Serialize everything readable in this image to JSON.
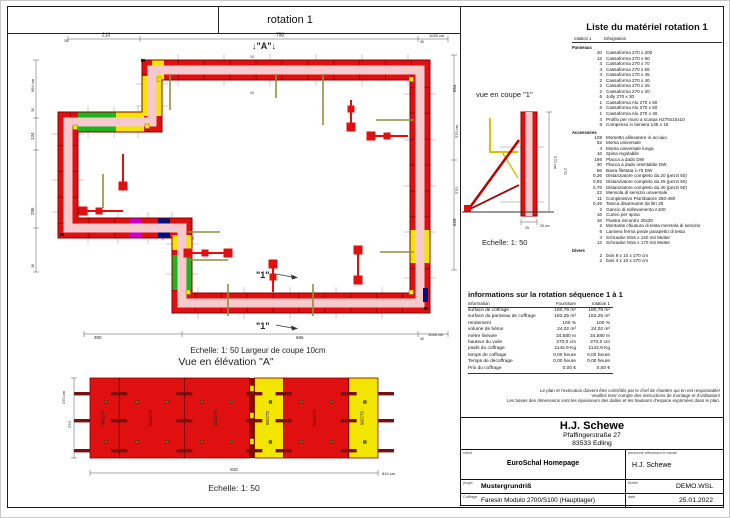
{
  "sheet": {
    "tab_label": "rotation 1"
  },
  "plan": {
    "marker_a": "↓\"A\"↓",
    "marker_1": "\"1\"",
    "dims": {
      "top_25": "25",
      "top_210": "210",
      "top_750": "750",
      "top_30": "30",
      "top_total": "1045 cm",
      "left_total": "694 cm",
      "left_30": "30",
      "left_134": "134",
      "left_295": "295",
      "left_36": "36",
      "right_654": "654",
      "right_628": "628",
      "bottom_300": "300",
      "bottom_665": "665",
      "bottom_30": "30",
      "bottom_total": "1045 cm",
      "tie_10a": "10",
      "tie_10b": "10",
      "wall_15a": "15",
      "wall_15b": "15"
    }
  },
  "coupe": {
    "title": "vue en coupe \"1\"",
    "scale": "Echelle: 1: 50",
    "dim_left_outer": "270 cm",
    "dim_left_inner": "270",
    "dim_right_outer": "270 cm",
    "dim_right_inner": "270",
    "dim_25": "25",
    "dim_25cm": "25 cm"
  },
  "elevation": {
    "scale_note": "Echelle: 1: 50   Largeur de coupe 10cm",
    "title": "Vue en élévation \"A\"",
    "panels": [
      {
        "size": "90/270",
        "width_cm": 90,
        "color": "red"
      },
      {
        "size": "200/270",
        "width_cm": 200,
        "color": "red"
      },
      {
        "size": "200/270",
        "width_cm": 200,
        "color": "red"
      },
      {
        "size": "",
        "width_cm": 15,
        "color": "joint"
      },
      {
        "size": "90/270",
        "width_cm": 90,
        "color": "yellow"
      },
      {
        "size": "200/270",
        "width_cm": 200,
        "color": "red"
      },
      {
        "size": "90/270",
        "width_cm": 90,
        "color": "yellow"
      }
    ],
    "dim_height_outer": "270 cm",
    "dim_height": "270",
    "dim_width": "810",
    "dim_width_total": "810 cm",
    "scale": "Echelle: 1: 50"
  },
  "material_list": {
    "title": "Liste du matériel  rotation 1",
    "col_qty": "rotation 1",
    "col_name": "Désignation",
    "sections": [
      {
        "name": "Panneaux",
        "items": [
          [
            "20",
            "Cassaforma 270 x 200"
          ],
          [
            "12",
            "Cassaforma 270 x 90"
          ],
          [
            "4",
            "Cassaforma 270 x 70"
          ],
          [
            "4",
            "Cassaforma 270 x 55"
          ],
          [
            "4",
            "Cassaforma 270 x 45"
          ],
          [
            "2",
            "Cassaforma 270 x 40"
          ],
          [
            "2",
            "Cassaforma 270 x 25"
          ],
          [
            "2",
            "Cassaforma 270 x 20"
          ],
          [
            "6",
            "Jolly 270 x 30"
          ],
          [
            "1",
            "Cassaforma Alu 270 x 60"
          ],
          [
            "6",
            "Cassaforma Alu 270 x 50"
          ],
          [
            "1",
            "Cassaforma Alu 270 x 40"
          ],
          [
            "4",
            "Profilo per muro a scarpa H270x10x10"
          ],
          [
            "6",
            "Compenso in lamiera 135 x 15"
          ]
        ]
      },
      {
        "name": "Accessoires",
        "items": [
          [
            "108",
            "Morsetto allineatore in acciaio"
          ],
          [
            "52",
            "Morsa universale"
          ],
          [
            "4",
            "Morsa universale lunga"
          ],
          [
            "16",
            "Spina regolabile"
          ],
          [
            "166",
            "Placca a dado DW"
          ],
          [
            "30",
            "Placca a dado orientabile DW"
          ],
          [
            "56",
            "Barra filettata l=75 DW"
          ],
          [
            "0,26",
            "Distanziatore completo da 20 (pezzi 50)"
          ],
          [
            "0,92",
            "Distanziatore completo da 25 (pezzi 50)"
          ],
          [
            "0,78",
            "Distanziatore completo da 30 (pezzi 50)"
          ],
          [
            "22",
            "Mensola di servizio universale"
          ],
          [
            "11",
            "Complessivo Piombatore 250-450"
          ],
          [
            "0,49",
            "Tanica disarmante da litri 25"
          ],
          [
            "2",
            "Gancio di sollevamento A100"
          ],
          [
            "16",
            "Cuneo per spina"
          ],
          [
            "16",
            "Piastra riscontro 20x20"
          ],
          [
            "2",
            "Montante chiusura di testa mensola di servizio"
          ],
          [
            "6",
            "Lamiera ferma piede parapetto di testa"
          ],
          [
            "4",
            "Schraube M16 x 140 mit Mutter"
          ],
          [
            "12",
            "Schraube M16 x 170 mit Mutter"
          ]
        ]
      },
      {
        "name": "Divers",
        "items": [
          [
            "2",
            "bois 9 x 10 x 270 cm"
          ],
          [
            "2",
            "bois 4 x 10 x 270 cm"
          ]
        ]
      }
    ]
  },
  "info_table": {
    "title": "informations sur la rotation  séquence 1 à 1",
    "columns": [
      "information",
      "Fourniture",
      "rotation 1"
    ],
    "rows": [
      [
        "surface de coffrage",
        "180,79 m²",
        "180,79 m²"
      ],
      [
        "surface du panneau de coffrage",
        "182,25 m²",
        "182,25 m²"
      ],
      [
        "rendement",
        "100 %",
        "100 %"
      ],
      [
        "volume de béton",
        "24,02 m³",
        "24,02 m³"
      ],
      [
        "mètre linéaire",
        "34,580 m",
        "34,580 m"
      ],
      [
        "hauteur du voile",
        "270,0 cm",
        "270,0 cm"
      ],
      [
        "poids du coffrage",
        "1142,9 Kg",
        "1142,9 Kg"
      ],
      [
        "temps de coffrage",
        "0,00 heure",
        "0,00 heure"
      ],
      [
        "Temps de décoffrage",
        "0,00 heure",
        "0,00 heure"
      ],
      [
        "Prix du coffrage",
        "0,00 €",
        "0,00 €"
      ]
    ]
  },
  "disclaimer": {
    "lines": [
      "Le plan et l'exécution doivent être contrôlés par le chef de chantier qui en est responsable!",
      "Veuillez tenir compte des instructions de montage et d'utilisation!",
      "Les bases des dimensions sont les épaisseurs des dalles et les hauteurs d'espace exprimées dans le plan."
    ]
  },
  "title_block": {
    "company": "H.J. Schewe",
    "address1": "Pfaffingerstraße 27",
    "address2": "83533 Edling",
    "client_label": "client",
    "client": "EuroSchal Homepage",
    "worker_label": "personne effectuant le travail",
    "worker": "H.J. Schewe",
    "project_label": "projet",
    "project": "Mustergrundriß",
    "file_label": "fichier",
    "file": "DEMO.WSL",
    "formwork_label": "Coffrage",
    "formwork": "Faresin Modulo 2700/S100 (Hauptlager)",
    "date_label": "date",
    "date": "25.01.2022"
  },
  "colors": {
    "panel_red": "#e01010",
    "panel_dark_red": "#8b0000",
    "panel_yellow": "#f2e500",
    "panel_green": "#1db51d",
    "wall_pink": "#f6c9cc",
    "accent_magenta": "#cc00cc",
    "accent_navy": "#001080",
    "brace_red": "#cc0000",
    "waler_olive": "#8f8f3f",
    "tie_green": "#5a7a1e"
  }
}
